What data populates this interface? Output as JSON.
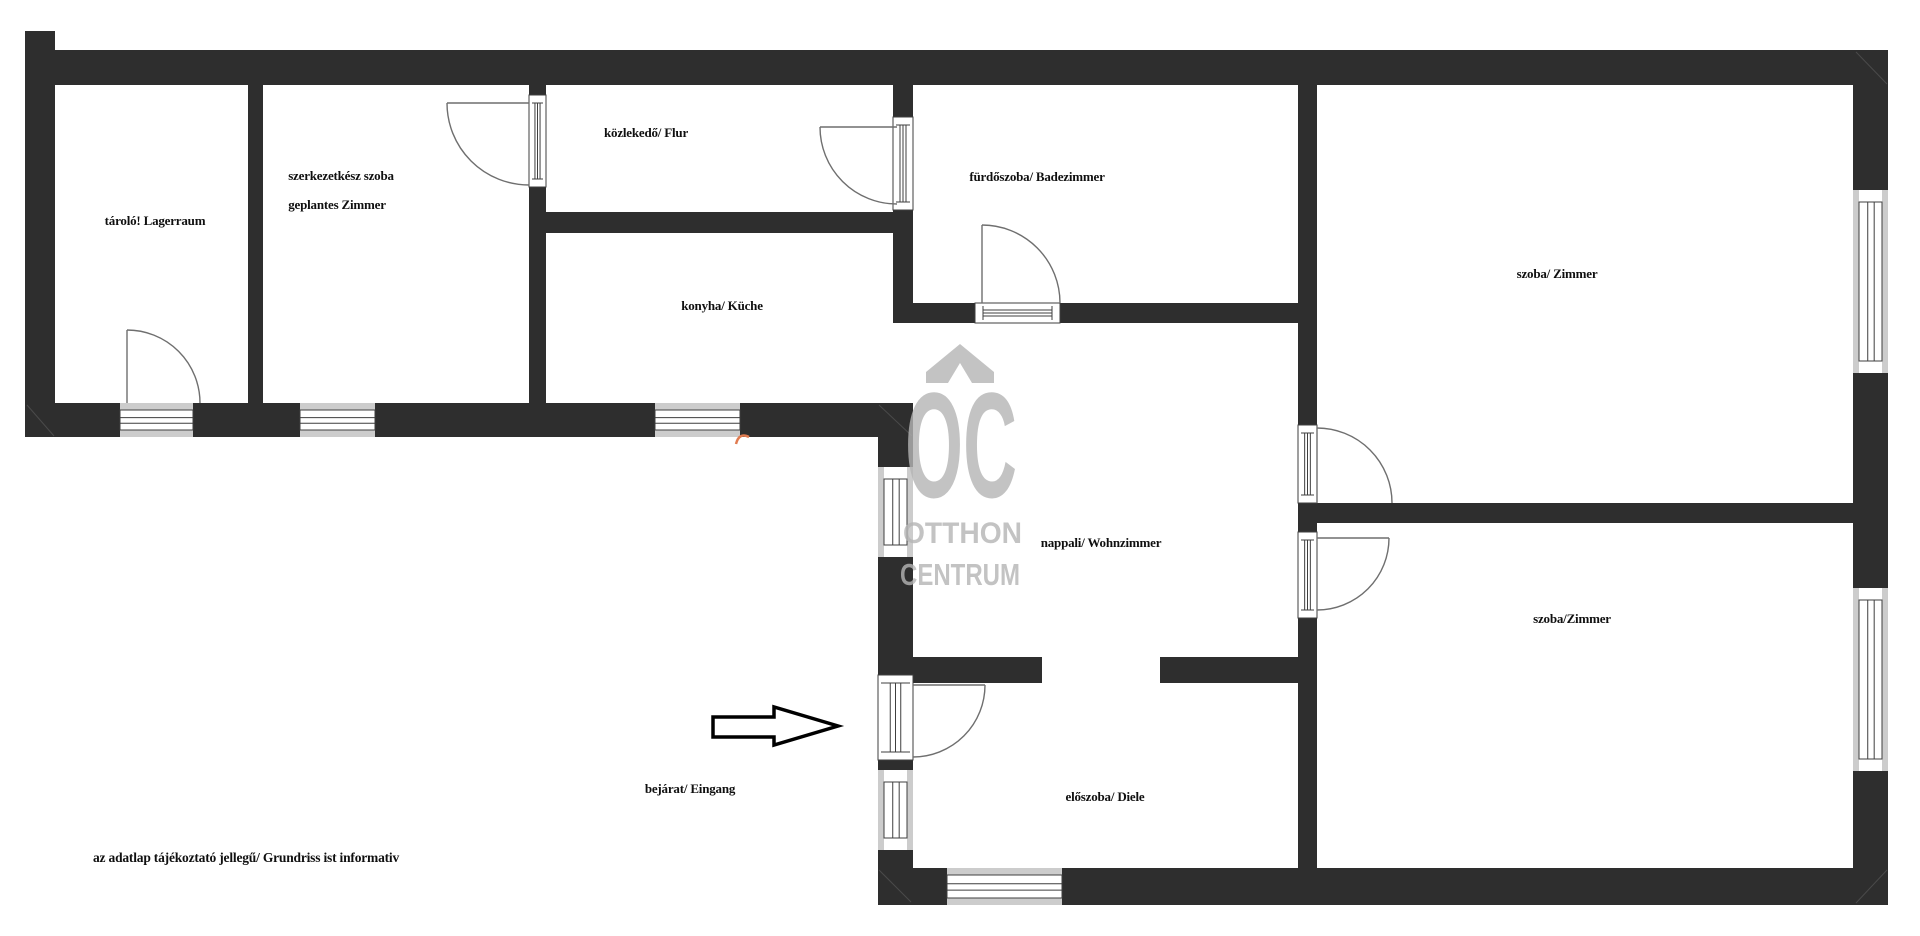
{
  "page": {
    "kind": "real-estate floor plan drawing",
    "background": "#ffffff"
  },
  "colors": {
    "wall": "#2e2e2e",
    "window_band": "#cccccc",
    "frame_line": "#3f3f3f",
    "arc_line": "#6f6f6f",
    "label_text": "#101010",
    "watermark": "#b5b5b5",
    "artifact": "#e07b50",
    "arrow_fill": "#ffffff",
    "arrow_stroke": "#000000"
  },
  "labels": [
    {
      "id": "taro",
      "text": "tároló! Lagerraum",
      "x": 155,
      "y": 225
    },
    {
      "id": "szerk1",
      "text": "szerkezetkész szoba",
      "x": 341,
      "y": 180
    },
    {
      "id": "szerk2",
      "text": "geplantes Zimmer",
      "x": 337,
      "y": 209
    },
    {
      "id": "kozlekedo",
      "text": "közlekedő/ Flur",
      "x": 646,
      "y": 137
    },
    {
      "id": "konyha",
      "text": "konyha/ Küche",
      "x": 722,
      "y": 310
    },
    {
      "id": "furdoszoba",
      "text": "fürdőszoba/ Badezimmer",
      "x": 1037,
      "y": 181
    },
    {
      "id": "szoba-top",
      "text": "szoba/ Zimmer",
      "x": 1557,
      "y": 278
    },
    {
      "id": "nappali",
      "text": "nappali/ Wohnzimmer",
      "x": 1101,
      "y": 547
    },
    {
      "id": "szoba-bot",
      "text": "szoba/Zimmer",
      "x": 1572,
      "y": 623
    },
    {
      "id": "eloszoba",
      "text": "előszoba/ Diele",
      "x": 1105,
      "y": 801
    },
    {
      "id": "bejarat",
      "text": "bejárat/ Eingang",
      "x": 690,
      "y": 793
    }
  ],
  "disclaimer": {
    "text": "az adatlap tájékoztató jellegű/ Grundriss ist informativ",
    "x": 93,
    "y": 862
  },
  "watermark": {
    "logo_text": "OC",
    "line1": "OTTHON",
    "line2": "CENTRUM",
    "opacity": 0.8,
    "chevron_path": "M926,383 L926,372 L960,344 L994,372 L994,383 L972,383 L960,363 L948,383 Z",
    "logo": {
      "x": 905,
      "y": 497,
      "size": 150,
      "length": 112
    },
    "text1": {
      "x": 903,
      "y": 543,
      "size": 30,
      "length": 119
    },
    "text2": {
      "x": 900,
      "y": 585,
      "size": 31,
      "length": 120
    }
  },
  "entrance_arrow": {
    "points": "713,717 774,717 774,707 838,726 774,745 774,737 713,737"
  },
  "artifact": {
    "path": "M736,444 Q739,432 749,437"
  },
  "plan": {
    "walls": [
      {
        "name": "outer-left-bar",
        "x": 25,
        "y": 31,
        "w": 30,
        "h": 406
      },
      {
        "name": "outer-top",
        "x": 55,
        "y": 50,
        "w": 1833,
        "h": 35
      },
      {
        "name": "top-strip-bottom",
        "x": 25,
        "y": 403,
        "w": 888,
        "h": 34
      },
      {
        "name": "divider-storage-room2",
        "x": 248,
        "y": 85,
        "w": 15,
        "h": 318
      },
      {
        "name": "room2-right",
        "x": 529,
        "y": 85,
        "w": 17,
        "h": 318
      },
      {
        "name": "flur-bottom",
        "x": 546,
        "y": 212,
        "w": 347,
        "h": 21
      },
      {
        "name": "bath-left",
        "x": 893,
        "y": 85,
        "w": 20,
        "h": 238
      },
      {
        "name": "bath-bottom",
        "x": 893,
        "y": 303,
        "w": 405,
        "h": 20
      },
      {
        "name": "central-vertical",
        "x": 1298,
        "y": 85,
        "w": 19,
        "h": 783
      },
      {
        "name": "divider-right-rooms",
        "x": 1317,
        "y": 503,
        "w": 536,
        "h": 20
      },
      {
        "name": "outer-right",
        "x": 1853,
        "y": 85,
        "w": 35,
        "h": 820
      },
      {
        "name": "outer-bottom",
        "x": 878,
        "y": 868,
        "w": 1010,
        "h": 37
      },
      {
        "name": "entrance-left",
        "x": 878,
        "y": 437,
        "w": 35,
        "h": 431
      },
      {
        "name": "hall-livingroom-stub-left",
        "x": 913,
        "y": 657,
        "w": 129,
        "h": 26
      },
      {
        "name": "hall-livingroom-stub-right",
        "x": 1160,
        "y": 657,
        "w": 138,
        "h": 26
      }
    ],
    "miters": [
      [
        27,
        405,
        54,
        436
      ],
      [
        1856,
        52,
        1887,
        84
      ],
      [
        1856,
        903,
        1887,
        870
      ],
      [
        879,
        405,
        912,
        436
      ],
      [
        879,
        870,
        911,
        902
      ]
    ],
    "windows": [
      {
        "name": "storage-terrace-door",
        "x": 120,
        "y": 403,
        "w": 73,
        "h": 34,
        "dir": "h"
      },
      {
        "name": "room2-window",
        "x": 300,
        "y": 403,
        "w": 75,
        "h": 34,
        "dir": "h"
      },
      {
        "name": "kitchen-window",
        "x": 655,
        "y": 403,
        "w": 85,
        "h": 34,
        "dir": "h"
      },
      {
        "name": "hall-window",
        "x": 947,
        "y": 868,
        "w": 115,
        "h": 37,
        "dir": "h"
      },
      {
        "name": "livingroom-window",
        "x": 878,
        "y": 467,
        "w": 35,
        "h": 90,
        "dir": "v"
      },
      {
        "name": "entrance-side-window",
        "x": 878,
        "y": 770,
        "w": 35,
        "h": 80,
        "dir": "v"
      },
      {
        "name": "room-top-window",
        "x": 1853,
        "y": 190,
        "w": 35,
        "h": 183,
        "dir": "v"
      },
      {
        "name": "room-bottom-window",
        "x": 1853,
        "y": 588,
        "w": 35,
        "h": 183,
        "dir": "v"
      }
    ],
    "door_frames": [
      {
        "name": "room2-flur-door-frame",
        "x": 529,
        "y": 95,
        "w": 17,
        "h": 92,
        "dir": "v"
      },
      {
        "name": "flur-bath-door-frame",
        "x": 893,
        "y": 117,
        "w": 20,
        "h": 93,
        "dir": "v"
      },
      {
        "name": "bath-bottom-door-frame",
        "x": 975,
        "y": 303,
        "w": 85,
        "h": 20,
        "dir": "h"
      },
      {
        "name": "entrance-door-frame",
        "x": 878,
        "y": 675,
        "w": 35,
        "h": 85,
        "dir": "v"
      },
      {
        "name": "room-top-door-frame",
        "x": 1298,
        "y": 425,
        "w": 19,
        "h": 78,
        "dir": "v"
      },
      {
        "name": "room-bottom-door-frame",
        "x": 1298,
        "y": 532,
        "w": 19,
        "h": 86,
        "dir": "v"
      }
    ],
    "door_arcs": [
      {
        "name": "storage-door-swing",
        "leaf": [
          127,
          330,
          127,
          403
        ],
        "arc": "M127,330 A73,73 0 0 1 200,403"
      },
      {
        "name": "room2-door-swing",
        "leaf": [
          447,
          103,
          529,
          103
        ],
        "arc": "M447,103 A82,82 0 0 0 529,185"
      },
      {
        "name": "flur-door-swing",
        "leaf": [
          820,
          127,
          897,
          127
        ],
        "arc": "M820,127 A77,77 0 0 0 897,204"
      },
      {
        "name": "bath-door-swing",
        "leaf": [
          982,
          225,
          982,
          303
        ],
        "arc": "M982,225 A78,78 0 0 1 1060,303"
      },
      {
        "name": "entrance-door-swing",
        "leaf": [
          913,
          685,
          985,
          685
        ],
        "arc": "M985,685 A72,72 0 0 1 913,757"
      },
      {
        "name": "room-top-door-swing",
        "leaf": [
          1317,
          428,
          1317,
          503
        ],
        "arc": "M1317,428 A75,75 0 0 1 1392,503"
      },
      {
        "name": "room-bottom-door-swing",
        "leaf": [
          1317,
          538,
          1389,
          538
        ],
        "arc": "M1389,538 A72,72 0 0 1 1317,610"
      }
    ]
  }
}
